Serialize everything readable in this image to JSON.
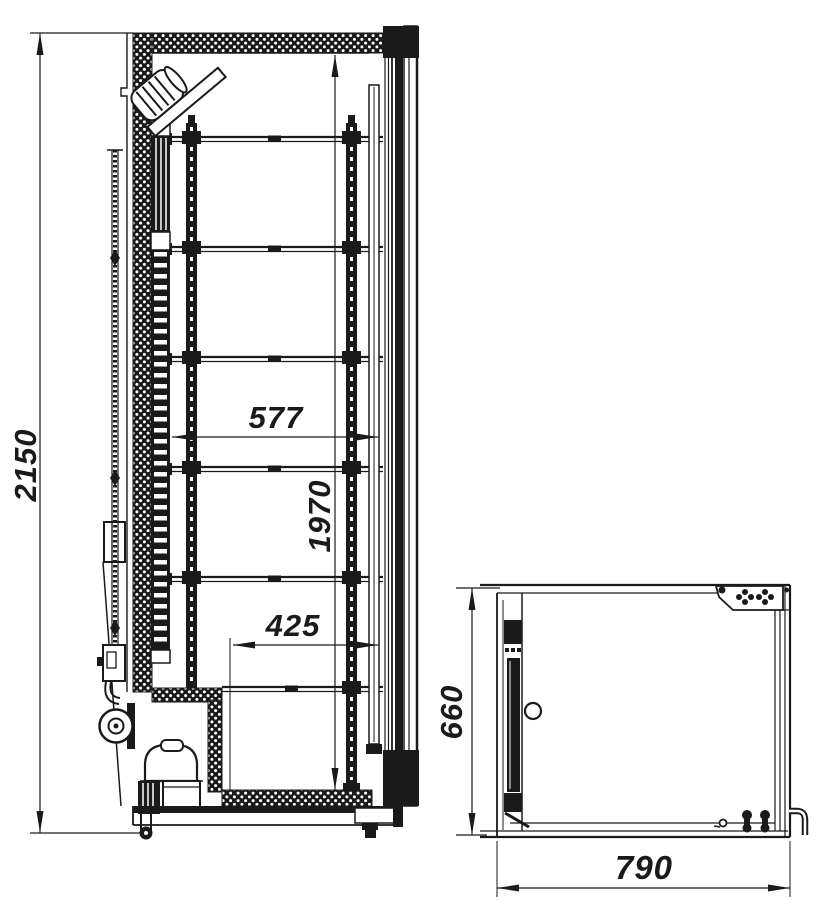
{
  "drawing": {
    "background_color": "#ffffff",
    "line_color": "#1a1a1a",
    "side_view": {
      "shelf_count": 6,
      "dims": {
        "overall_height": "2150",
        "interior_height": "1970",
        "upper_depth": "577",
        "lower_depth": "425"
      }
    },
    "top_view": {
      "dims": {
        "depth": "660",
        "width": "790"
      }
    }
  }
}
